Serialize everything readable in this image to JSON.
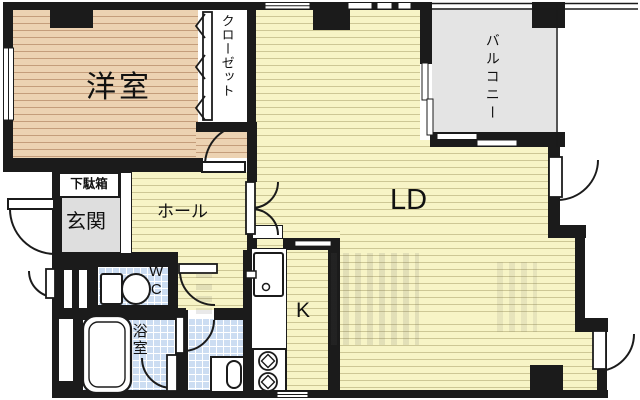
{
  "plan": {
    "title": "1LDK floor plan",
    "rooms": {
      "western": {
        "label": "洋室"
      },
      "closet": {
        "label": "クローゼット"
      },
      "balcony": {
        "label": "バルコニー"
      },
      "living_dining": {
        "label": "LD"
      },
      "kitchen": {
        "label": "K"
      },
      "hall": {
        "label": "ホール"
      },
      "entrance": {
        "label": "玄関"
      },
      "shoe_cabinet": {
        "label": "下駄箱"
      },
      "wc": {
        "label": "WC"
      },
      "bath": {
        "label": "浴室"
      }
    },
    "fixtures": [
      "toilet-icon",
      "bathtub-icon",
      "washing-machine-icon",
      "kitchen-sink-icon",
      "gas-stove-icon",
      "door-swing-arc",
      "sliding-window",
      "folding-closet-door",
      "balcony-railing"
    ],
    "colors": {
      "wall": "#1b1b1b",
      "western_floor": "#ecd2b2",
      "western_stripe": "#c49d7b",
      "yellow_floor": "#f7f4c6",
      "yellow_stripe": "#cdc795",
      "tile_floor": "#ccddf2",
      "tile_grid": "#ffffff",
      "balcony_floor": "#e4e4e4",
      "entrance_floor": "#dedede"
    }
  }
}
